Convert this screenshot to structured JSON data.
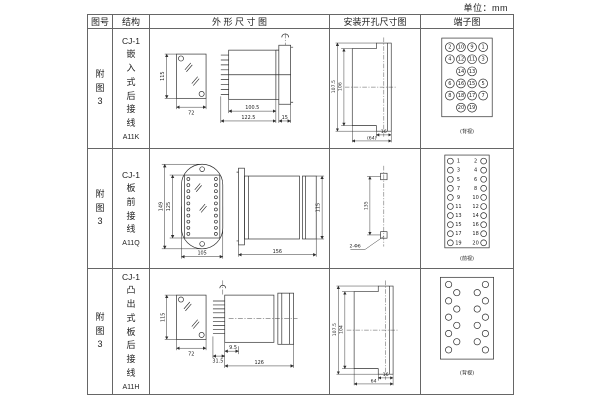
{
  "unit_label": "单位：mm",
  "columns": [
    "图号",
    "结构",
    "外 形 尺 寸 图",
    "安装开孔尺寸图",
    "端子图"
  ],
  "rows": [
    {
      "figure": "附图3",
      "model": "CJ-1",
      "desc": "嵌入式后接线",
      "code": "A11K",
      "outline": {
        "h": "115",
        "w": "72",
        "d1": "100.5",
        "d2": "122.5",
        "d3": "15"
      },
      "mount": {
        "v1": "107.5",
        "v2": "106",
        "h1": "16",
        "h2": "(64)"
      },
      "terminal": {
        "view": "(背视)"
      }
    },
    {
      "figure": "附图3",
      "model": "CJ-1",
      "desc": "板前接线",
      "code": "A11Q",
      "outline": {
        "h": "149",
        "h2": "125",
        "w": "105",
        "d1": "156",
        "d2": "115"
      },
      "mount": {
        "v1": "135",
        "label": "2-Φ6"
      },
      "terminal": {
        "view": "(前视)"
      }
    },
    {
      "figure": "附图3",
      "model": "CJ-1",
      "desc": "凸出式板后接线",
      "code": "A11H",
      "outline": {
        "h": "115",
        "w": "72",
        "d1": "31.5",
        "d2": "9.5",
        "d3": "126"
      },
      "mount": {
        "v1": "107.5",
        "v2": "104",
        "h1": "16",
        "h2": "64"
      },
      "terminal": {
        "view": "(背视)"
      }
    }
  ],
  "terminals": {
    "a11k_grid": [
      [
        "2",
        "10",
        "9",
        "1"
      ],
      [
        "4",
        "12",
        "11",
        "3"
      ],
      [
        "",
        "14",
        "13",
        ""
      ],
      [
        "6",
        "16",
        "15",
        "5"
      ],
      [
        "8",
        "18",
        "17",
        "7"
      ],
      [
        "",
        "20",
        "19",
        ""
      ]
    ],
    "a11q_left": [
      "1",
      "3",
      "5",
      "7",
      "9",
      "11",
      "13",
      "15",
      "17",
      "19"
    ],
    "a11q_right": [
      "2",
      "4",
      "6",
      "8",
      "10",
      "12",
      "14",
      "16",
      "18",
      "20"
    ]
  }
}
